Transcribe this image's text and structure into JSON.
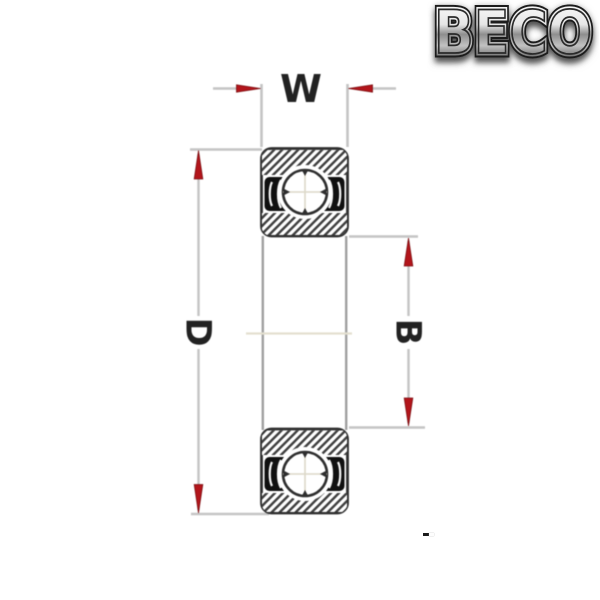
{
  "logo": {
    "text": "BECO",
    "style": "chrome-outline-metallic",
    "colors": {
      "highlight": "#f4f4f4",
      "mid": "#9a9a9a",
      "dark_edge": "#222222",
      "shadow": "#3a3a3a"
    }
  },
  "diagram": {
    "type": "deep-groove-ball-bearing-cross-section",
    "dimensions": {
      "width": {
        "label": "W",
        "orientation": "horizontal-top"
      },
      "outer_diameter": {
        "label": "D",
        "orientation": "vertical-left"
      },
      "bore": {
        "label": "B",
        "orientation": "vertical-right"
      }
    },
    "colors": {
      "arrow_red": "#b3151b",
      "outline_dark": "#2e2e2e",
      "dimension_line_gray": "#c4c4c4",
      "bore_line_gray": "#a0a0a0",
      "centerline_tint": "#e3dfcf",
      "seal_black": "#101010",
      "hatch_line": "#3f3f3f",
      "background": "#ffffff"
    }
  }
}
